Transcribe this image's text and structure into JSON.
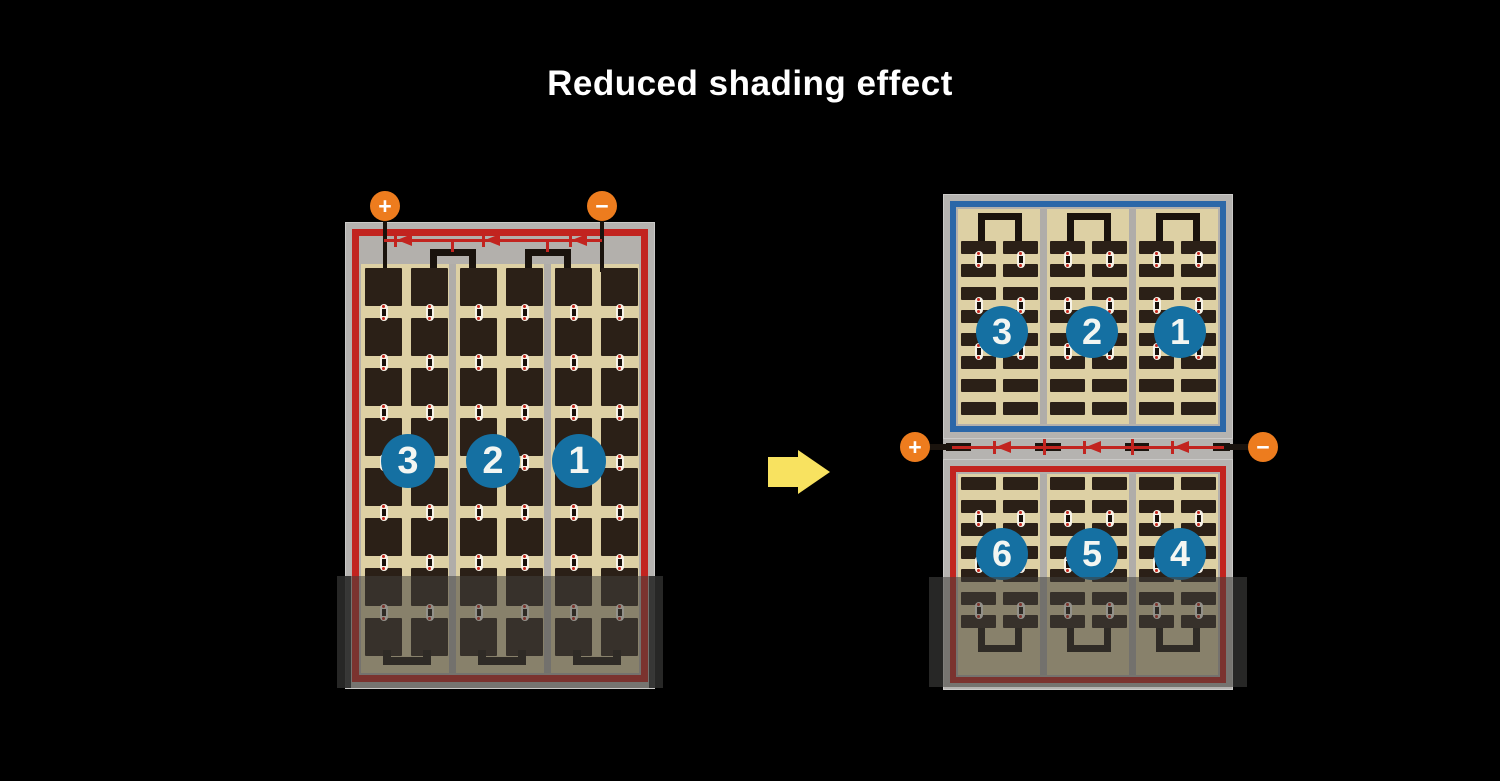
{
  "title": "Reduced shading effect",
  "colors": {
    "background": "#000000",
    "title_text": "#ffffff",
    "frame_gray": "#b5b3b0",
    "inner_gray": "#b3b0ac",
    "panel_tan": "#ddd0a4",
    "cell_dark": "#2b2017",
    "divider_gray": "#b0ada9",
    "wire_black": "#1a130d",
    "circuit_red": "#c2241f",
    "string_blue": "#2b67a8",
    "number_circle_blue": "#1570a2",
    "number_text": "#f3f6f2",
    "terminal_orange": "#ed7c1e",
    "terminal_text": "#ffffff",
    "dot_white": "#f7f3e8",
    "dot_red": "#c5261c",
    "arrow_yellow": "#f8e260",
    "shade": "rgba(66,64,60,0.55)",
    "shade_edge": "rgba(40,40,40,0.8)"
  },
  "left_module": {
    "terminals": [
      {
        "label": "+"
      },
      {
        "label": "−"
      }
    ],
    "bypass_diodes": 3,
    "cell_strings": [
      "3",
      "2",
      "1"
    ],
    "columns": 6,
    "rows": 8,
    "border_color": "red",
    "shaded_bottom": true
  },
  "right_module": {
    "terminals": [
      {
        "label": "+"
      },
      {
        "label": "−"
      }
    ],
    "bypass_diodes": 3,
    "top_half": {
      "cell_strings": [
        "3",
        "2",
        "1"
      ],
      "columns": 6,
      "rows": 8,
      "border_color": "blue"
    },
    "bottom_half": {
      "cell_strings": [
        "6",
        "5",
        "4"
      ],
      "columns": 6,
      "rows": 7,
      "border_color": "red",
      "shaded_bottom": true
    }
  },
  "arrow": {
    "direction": "right"
  }
}
